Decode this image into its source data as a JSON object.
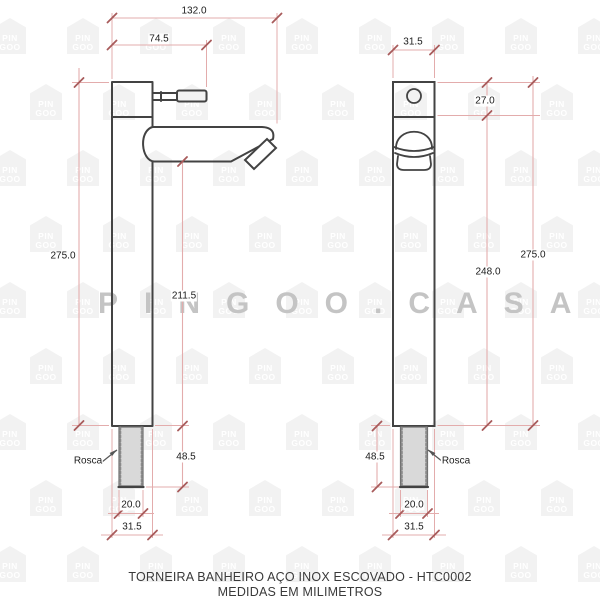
{
  "watermark": {
    "brand_text": "PINGOO.CASA",
    "logo_line1": "PIN",
    "logo_line2": "GOO"
  },
  "front_view": {
    "overall_width_mm": "132.0",
    "spout_reach_mm": "74.5",
    "total_height_mm": "275.0",
    "spout_height_mm": "211.5",
    "thread_length_mm": "48.5",
    "thread_label": "Rosca",
    "thread_diameter_mm": "20.0",
    "base_diameter_mm": "31.5"
  },
  "side_view": {
    "body_width_mm": "31.5",
    "cap_height_mm": "27.0",
    "lower_body_height_mm": "248.0",
    "total_height_mm": "275.0",
    "thread_length_mm": "48.5",
    "thread_label": "Rosca",
    "thread_diameter_mm": "20.0",
    "base_diameter_mm": "31.5"
  },
  "footer": {
    "title": "TORNEIRA BANHEIRO AÇO INOX ESCOVADO - HTC0002",
    "subtitle": "MEDIDAS EM MILIMETROS"
  },
  "colors": {
    "outline": "#434343",
    "dimension_line": "#e3acac",
    "dimension_tick": "#a85b5b",
    "watermark": "#c4c4c4"
  }
}
